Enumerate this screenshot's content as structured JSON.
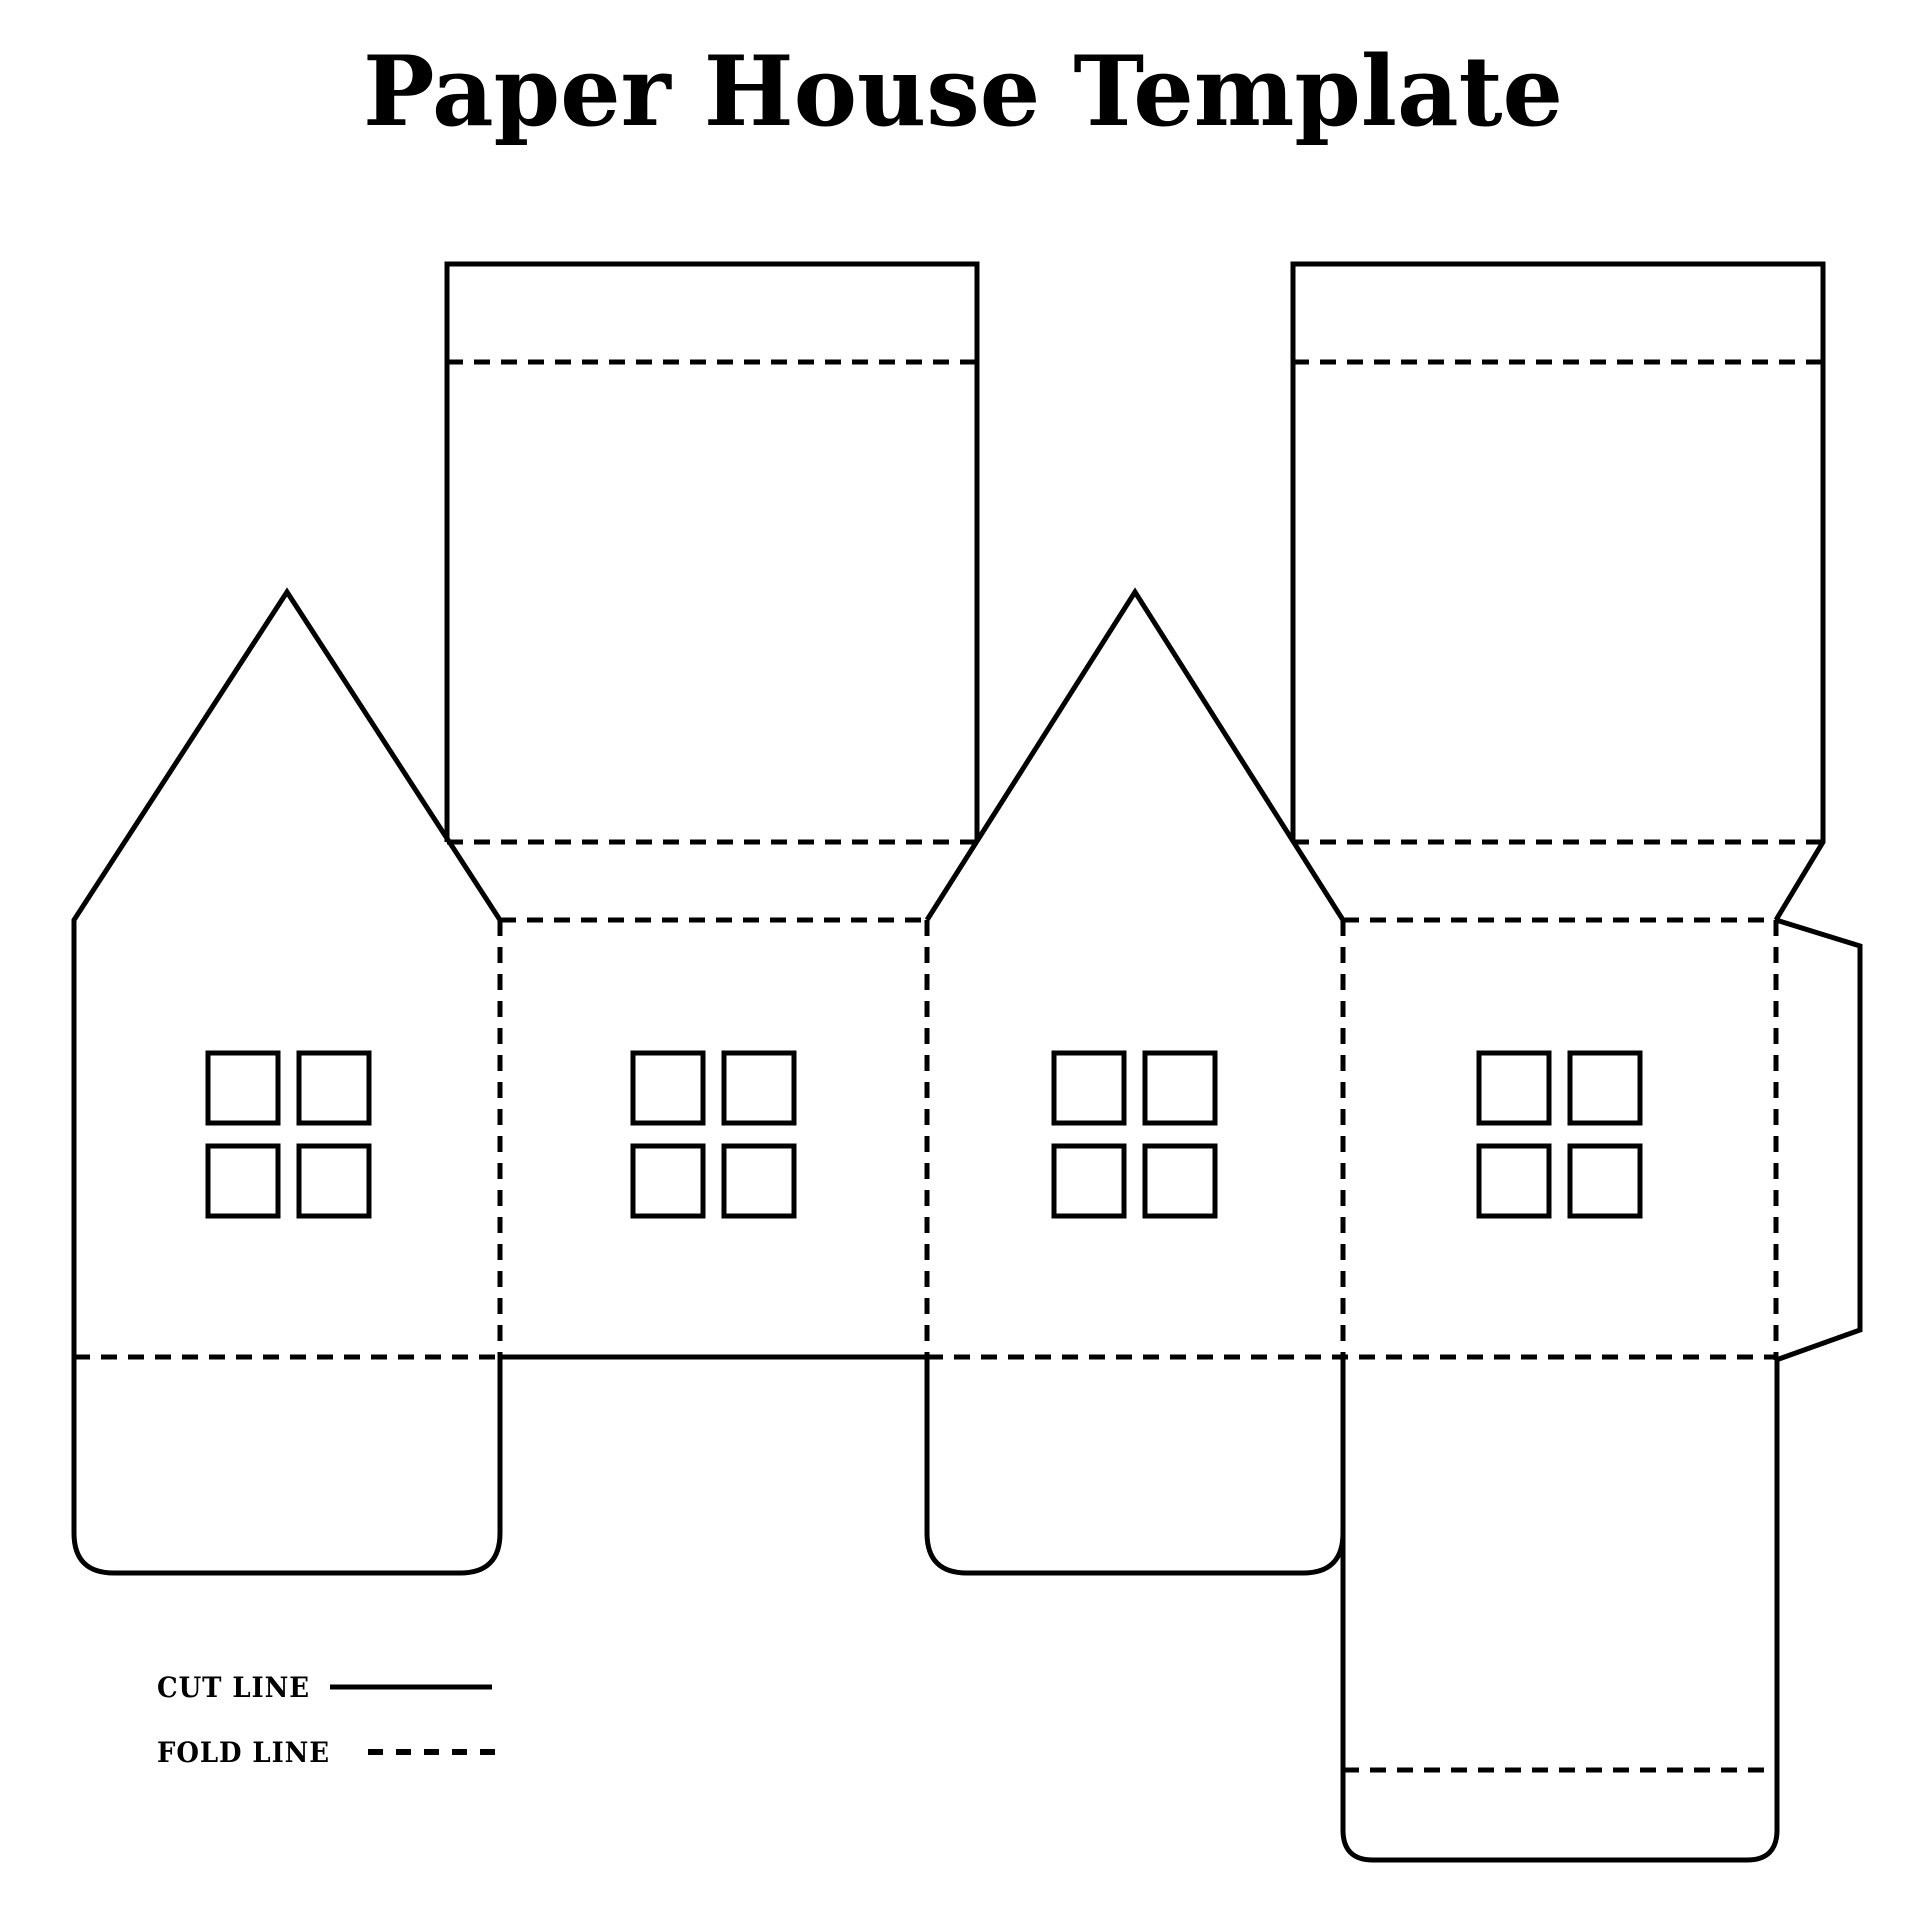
{
  "page": {
    "title": "Paper House Template",
    "background_color": "#ffffff",
    "line_color": "#000000"
  },
  "legend": {
    "cut": {
      "label": "CUT LINE",
      "style": "solid"
    },
    "fold": {
      "label": "FOLD LINE",
      "style": "dashed"
    }
  }
}
